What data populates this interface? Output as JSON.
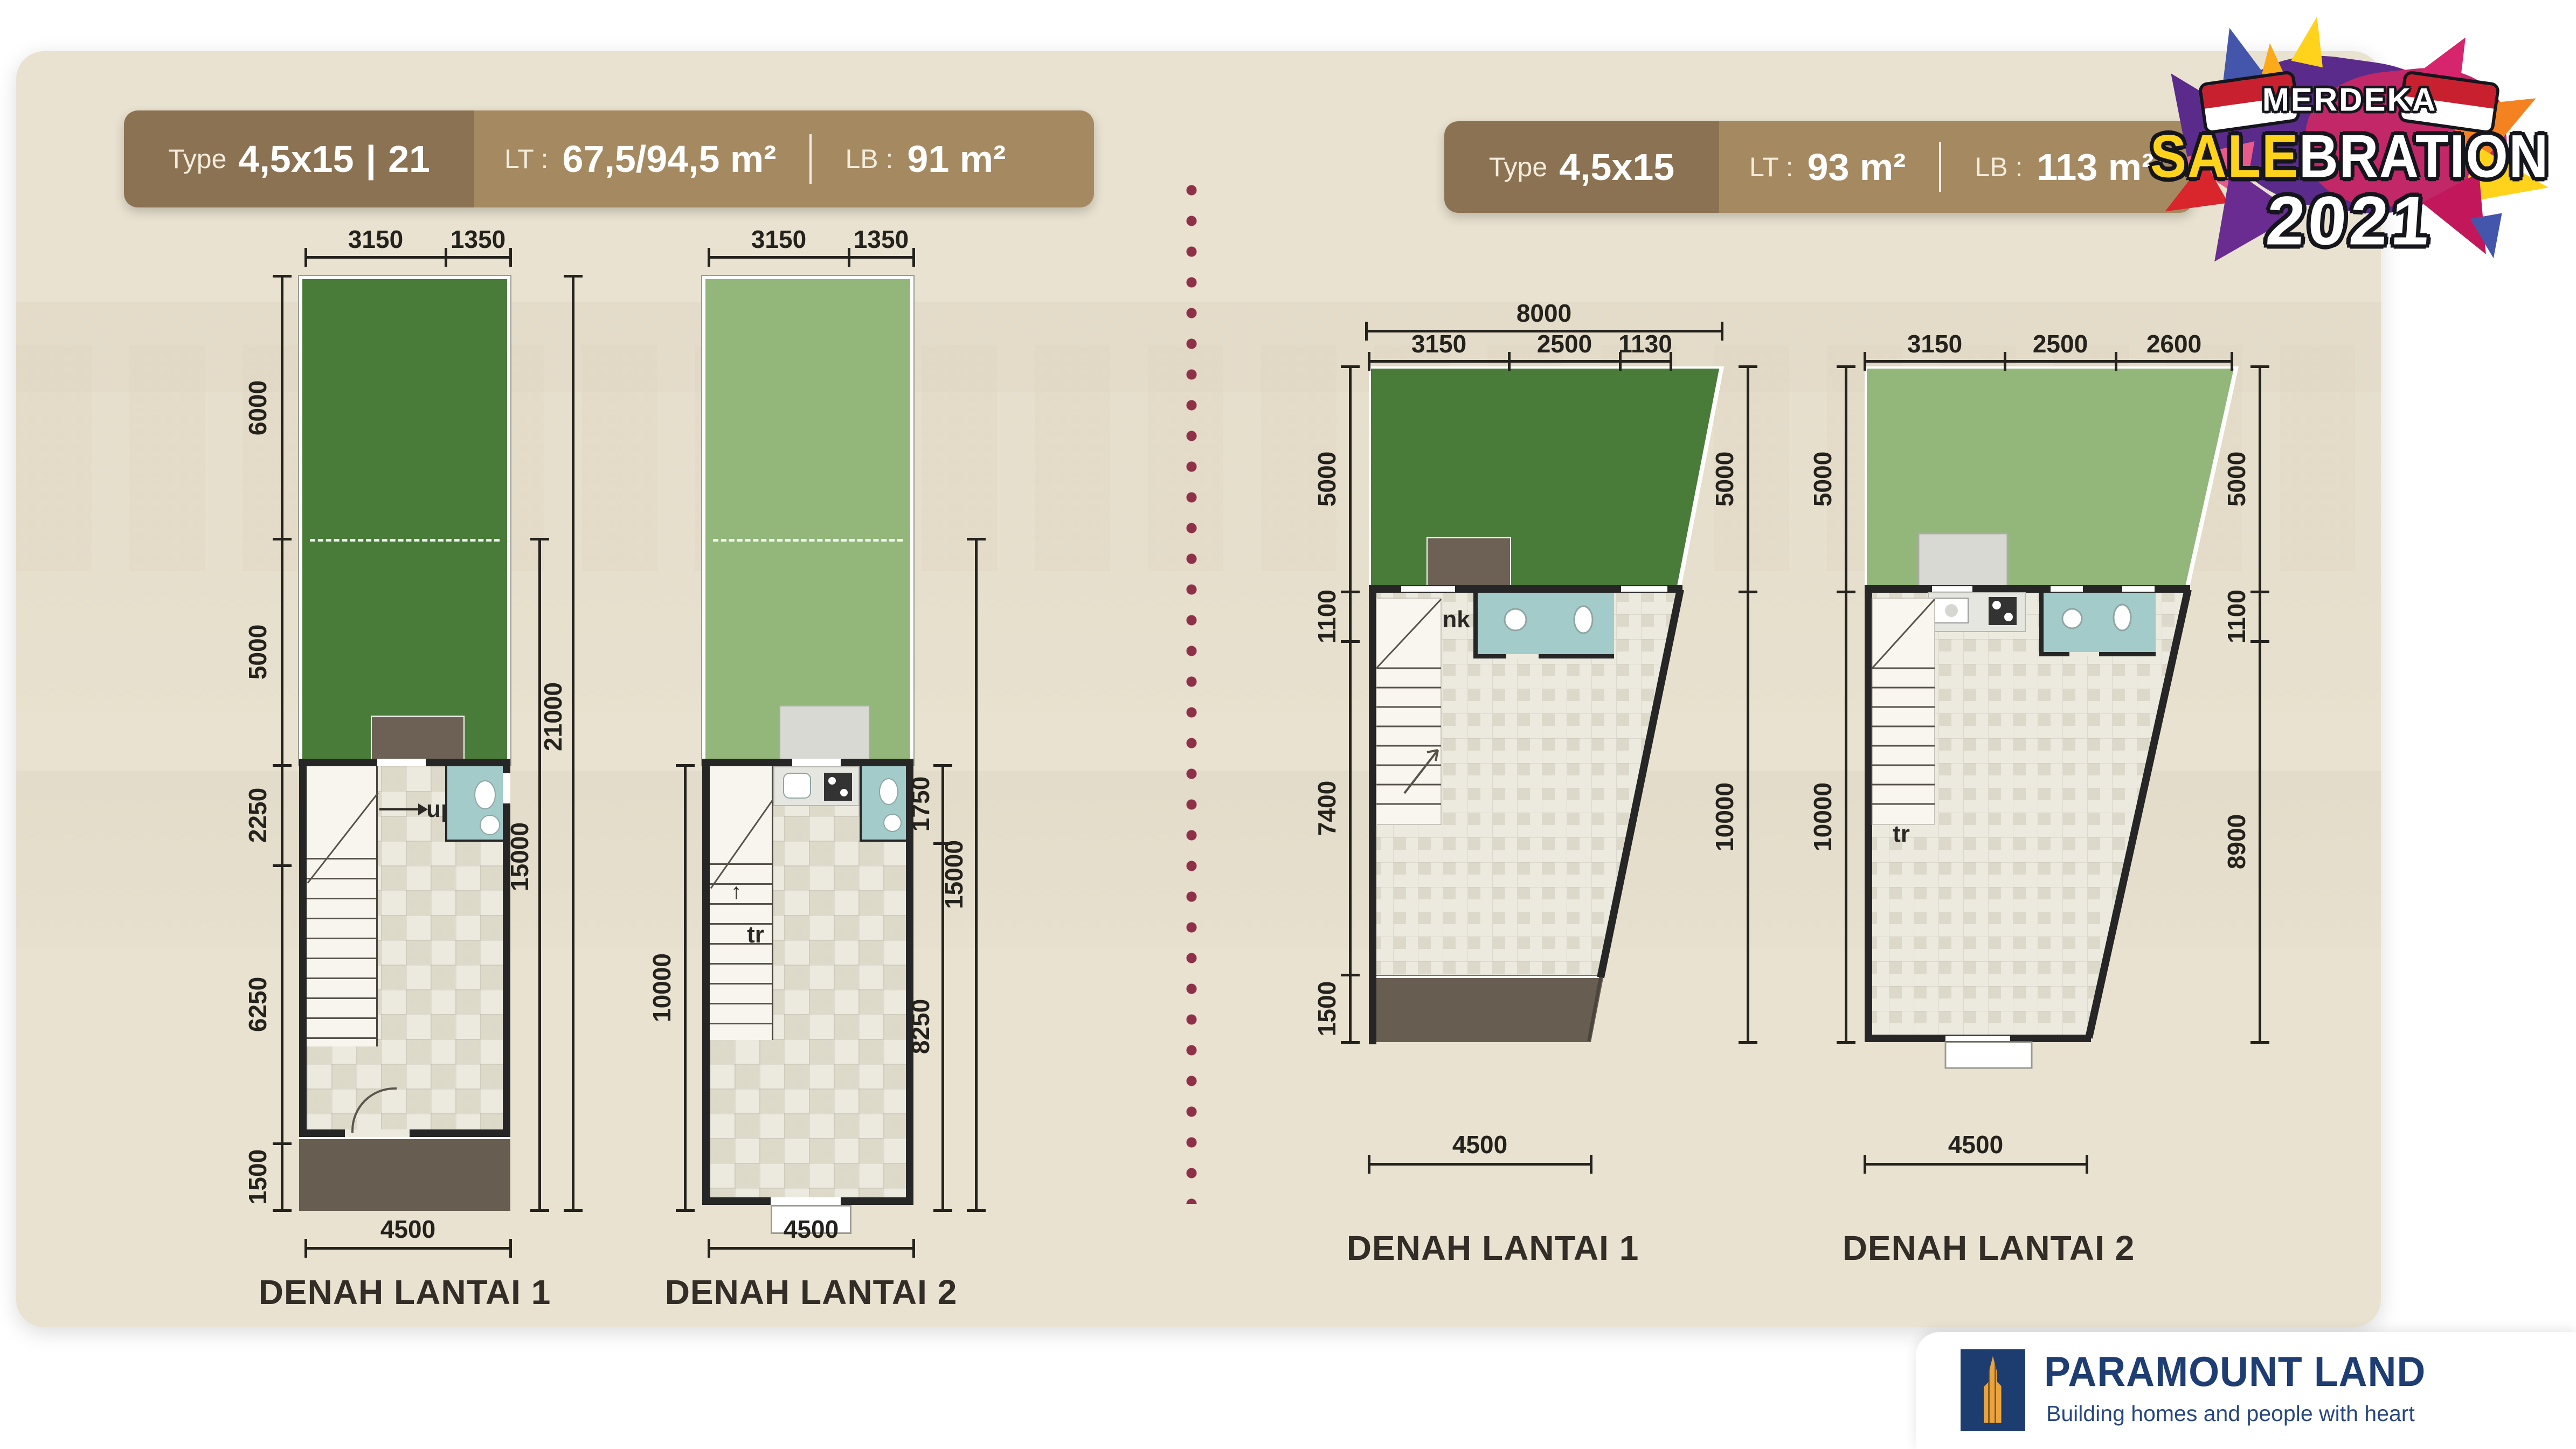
{
  "left_unit": {
    "header": {
      "type_label": "Type",
      "size": "4,5x15",
      "divider": "|",
      "unit": "21",
      "lt_label": "LT :",
      "lt_value": "67,5/94,5 m²",
      "sep": "|",
      "lb_label": "LB :",
      "lb_value": "91 m²"
    },
    "floor1": {
      "title": "DENAH LANTAI 1",
      "top_dims": [
        "3150",
        "1350"
      ],
      "left_dims": [
        "6000",
        "5000",
        "2250",
        "6250",
        "1500"
      ],
      "right_inner": "15000",
      "right_outer": "21000",
      "bottom": "4500",
      "stair_note": "up"
    },
    "floor2": {
      "title": "DENAH LANTAI 2",
      "top_dims": [
        "3150",
        "1350"
      ],
      "left_dim": "10000",
      "right_dims": [
        "1750",
        "8250"
      ],
      "right_outer": "15000",
      "bottom": "4500",
      "stair_note": "tr"
    }
  },
  "right_unit": {
    "header": {
      "type_label": "Type",
      "size": "4,5x15",
      "lt_label": "LT :",
      "lt_value": "93 m²",
      "sep": "|",
      "lb_label": "LB :",
      "lb_value": "113 m²"
    },
    "floor1": {
      "title": "DENAH LANTAI 1",
      "top_overall": "8000",
      "top_dims": [
        "3150",
        "2500",
        "1130"
      ],
      "left_dims": [
        "5000",
        "1100",
        "7400",
        "1500"
      ],
      "right_dims": [
        "5000",
        "10000"
      ],
      "bottom": "4500",
      "note": "nk"
    },
    "floor2": {
      "title": "DENAH LANTAI 2",
      "top_dims": [
        "3150",
        "2500",
        "2600"
      ],
      "left_dims": [
        "5000",
        "10000"
      ],
      "right_dims": [
        "5000",
        "1100",
        "8900"
      ],
      "bottom": "4500",
      "stair_note": "tr"
    }
  },
  "promo": {
    "merdeka": "MERDEKA",
    "sale": "SALE",
    "bration": "BRATION",
    "year": "2021"
  },
  "brand": {
    "name": "PARAMOUNT LAND",
    "tagline": "Building homes and people with heart"
  },
  "colors": {
    "card": "#e9e2d0",
    "header_dark": "#8b7252",
    "header_light": "#a58a61",
    "grass_dark": "#4a7c39",
    "grass_light": "#93b77a",
    "bath_blue": "#a3cbc9",
    "wall": "#262626",
    "porch": "#675d51",
    "dim_text": "#24221d",
    "divider_dot": "#8e3048",
    "brand_navy": "#1d3c70",
    "brand_gold": "#e9a43e",
    "sale_yellow": "#ffd31c",
    "flag_red": "#c8202f"
  }
}
